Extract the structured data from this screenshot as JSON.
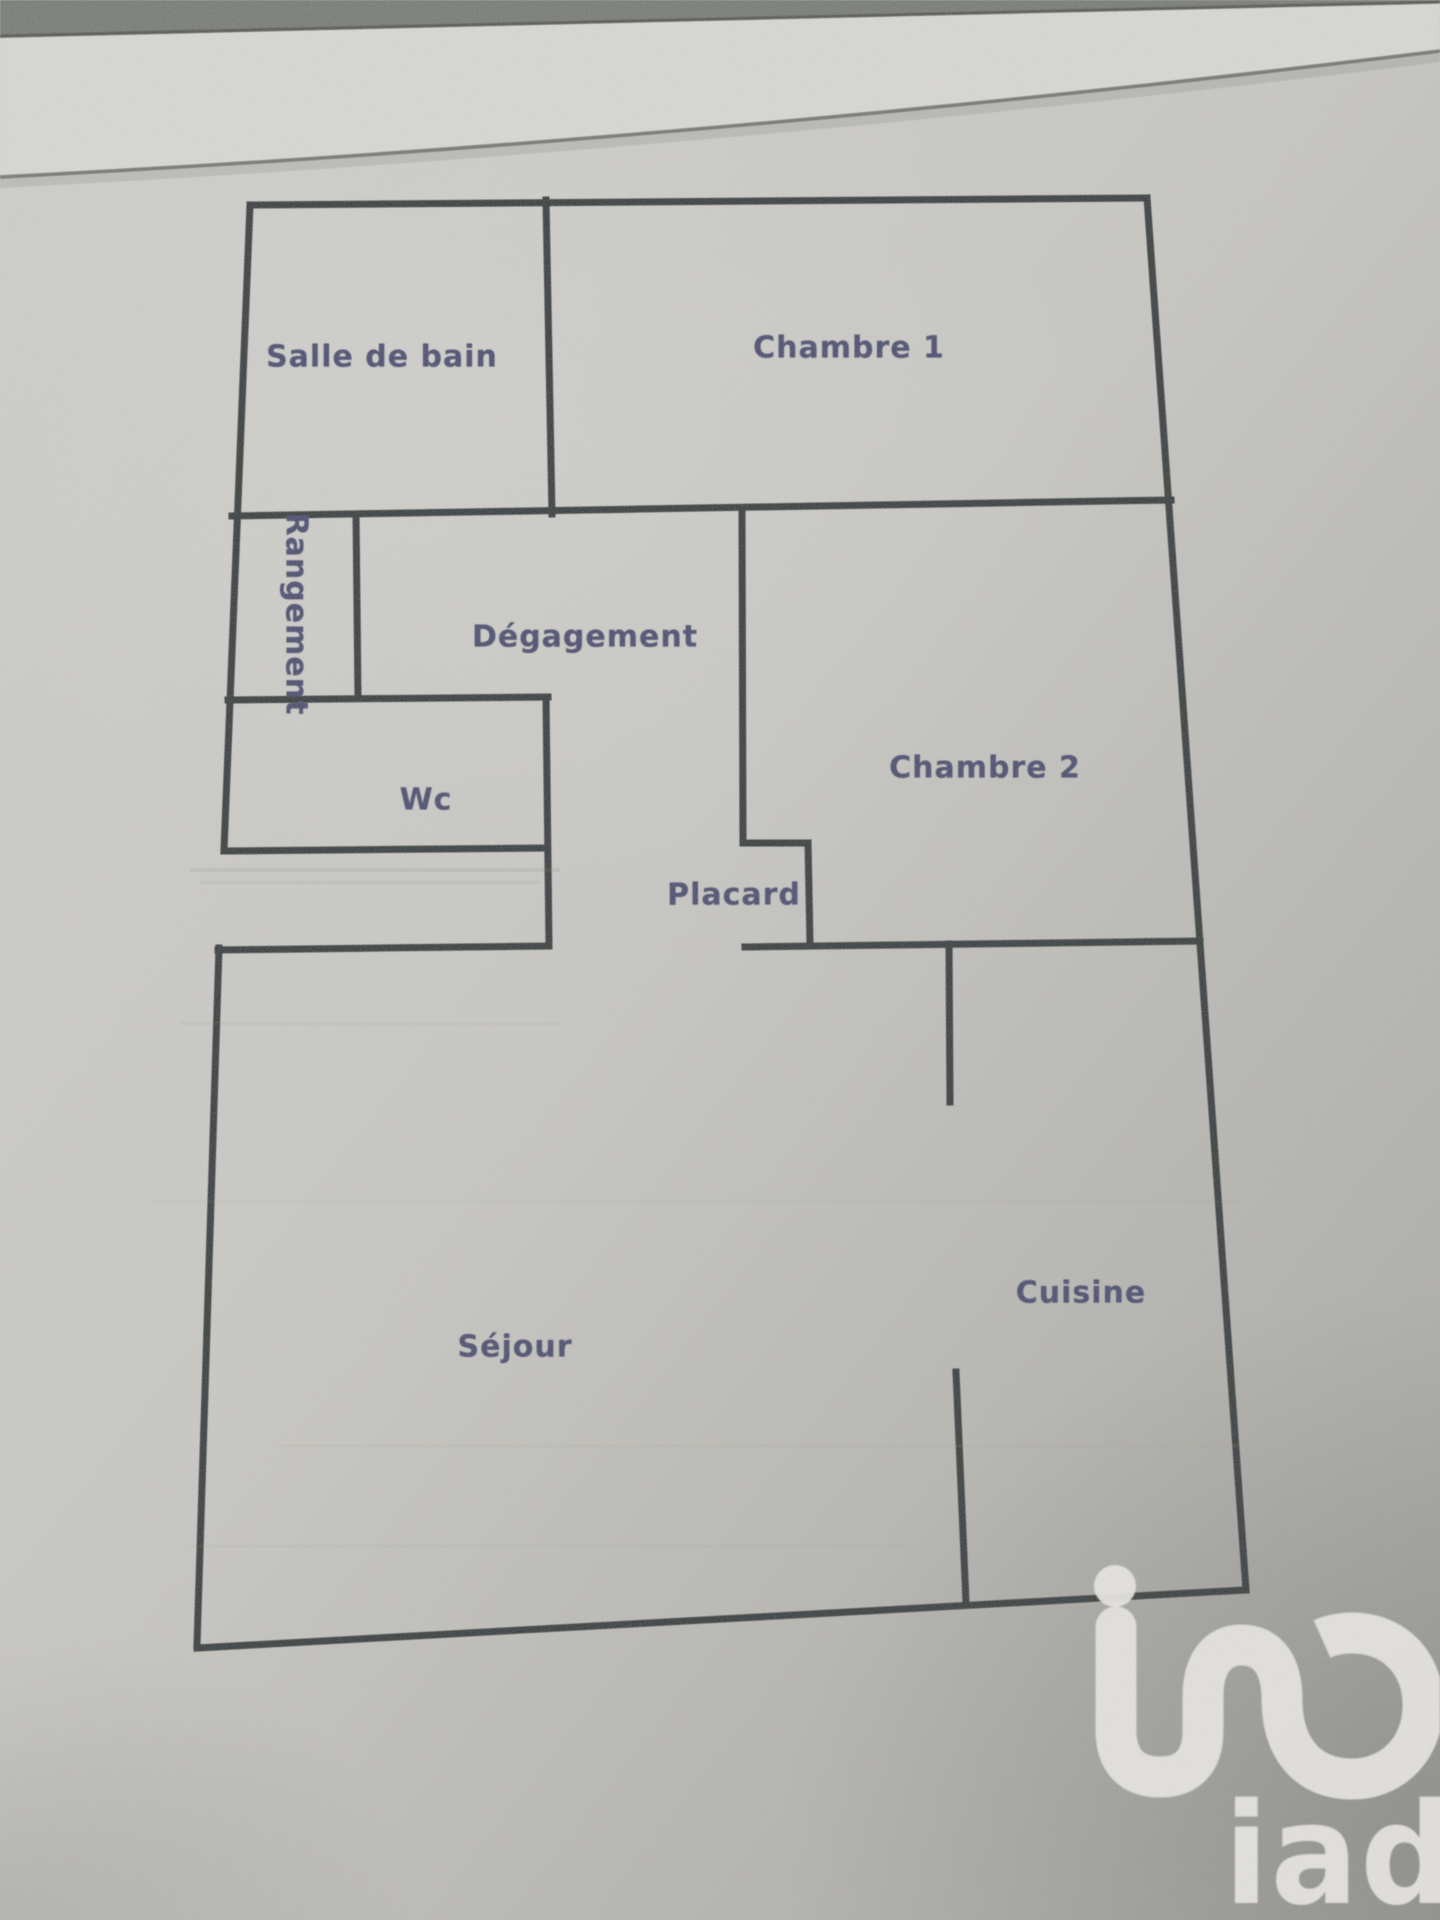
{
  "photo": {
    "top_band_color": "#6f736c",
    "sheet_edge_color": "#dcdbd7",
    "paper_color": "#cac9c5",
    "edge_line_color": "#4a4d45"
  },
  "floor_plan": {
    "wall_color": "#2a2f30",
    "wall_width": 7,
    "label_color": "#3f4166",
    "rooms": [
      {
        "id": "salle-de-bain",
        "label": "Salle de bain",
        "x": 382,
        "y": 357
      },
      {
        "id": "chambre-1",
        "label": "Chambre 1",
        "x": 849,
        "y": 348
      },
      {
        "id": "rangement",
        "label": "Rangement",
        "x": 296,
        "y": 614,
        "vertical": true
      },
      {
        "id": "degagement",
        "label": "Dégagement",
        "x": 585,
        "y": 637
      },
      {
        "id": "chambre-2",
        "label": "Chambre 2",
        "x": 985,
        "y": 768
      },
      {
        "id": "wc",
        "label": "Wc",
        "x": 426,
        "y": 800
      },
      {
        "id": "placard",
        "label": "Placard",
        "x": 734,
        "y": 895
      },
      {
        "id": "sejour",
        "label": "Séjour",
        "x": 515,
        "y": 1347
      },
      {
        "id": "cuisine",
        "label": "Cuisine",
        "x": 1081,
        "y": 1293
      }
    ],
    "walls": [
      {
        "x1": 250,
        "y1": 205,
        "x2": 1147,
        "y2": 198
      },
      {
        "x1": 250,
        "y1": 205,
        "x2": 224,
        "y2": 850
      },
      {
        "x1": 219,
        "y1": 948,
        "x2": 197,
        "y2": 1645
      },
      {
        "x1": 197,
        "y1": 1648,
        "x2": 1246,
        "y2": 1590
      },
      {
        "x1": 1147,
        "y1": 198,
        "x2": 1246,
        "y2": 1590
      },
      {
        "x1": 232,
        "y1": 516,
        "x2": 1171,
        "y2": 500
      },
      {
        "x1": 546,
        "y1": 200,
        "x2": 552,
        "y2": 514
      },
      {
        "x1": 356,
        "y1": 514,
        "x2": 358,
        "y2": 698
      },
      {
        "x1": 228,
        "y1": 700,
        "x2": 548,
        "y2": 697
      },
      {
        "x1": 546,
        "y1": 697,
        "x2": 549,
        "y2": 946
      },
      {
        "x1": 224,
        "y1": 851,
        "x2": 546,
        "y2": 848
      },
      {
        "x1": 218,
        "y1": 950,
        "x2": 548,
        "y2": 946
      },
      {
        "x1": 742,
        "y1": 514,
        "x2": 743,
        "y2": 843
      },
      {
        "x1": 743,
        "y1": 843,
        "x2": 808,
        "y2": 843
      },
      {
        "x1": 808,
        "y1": 843,
        "x2": 810,
        "y2": 944
      },
      {
        "x1": 745,
        "y1": 947,
        "x2": 1200,
        "y2": 941
      },
      {
        "x1": 949,
        "y1": 944,
        "x2": 950,
        "y2": 1102
      },
      {
        "x1": 956,
        "y1": 1372,
        "x2": 966,
        "y2": 1602
      }
    ],
    "streaks": [
      {
        "x": 190,
        "y": 868,
        "w": 370,
        "h": 4,
        "o": 0.18,
        "c": "#7e7f76"
      },
      {
        "x": 200,
        "y": 881,
        "w": 340,
        "h": 3,
        "o": 0.12,
        "c": "#7e7f76"
      },
      {
        "x": 180,
        "y": 1022,
        "w": 380,
        "h": 3,
        "o": 0.1,
        "c": "#8a8a7c"
      },
      {
        "x": 150,
        "y": 1200,
        "w": 1090,
        "h": 3,
        "o": 0.1,
        "c": "#9a9578"
      },
      {
        "x": 280,
        "y": 1444,
        "w": 960,
        "h": 3,
        "o": 0.12,
        "c": "#a59d74"
      },
      {
        "x": 190,
        "y": 1545,
        "w": 720,
        "h": 3,
        "o": 0.08,
        "c": "#8a8a7c"
      }
    ]
  },
  "logo": {
    "text": "iad",
    "color": "#eceae6"
  }
}
